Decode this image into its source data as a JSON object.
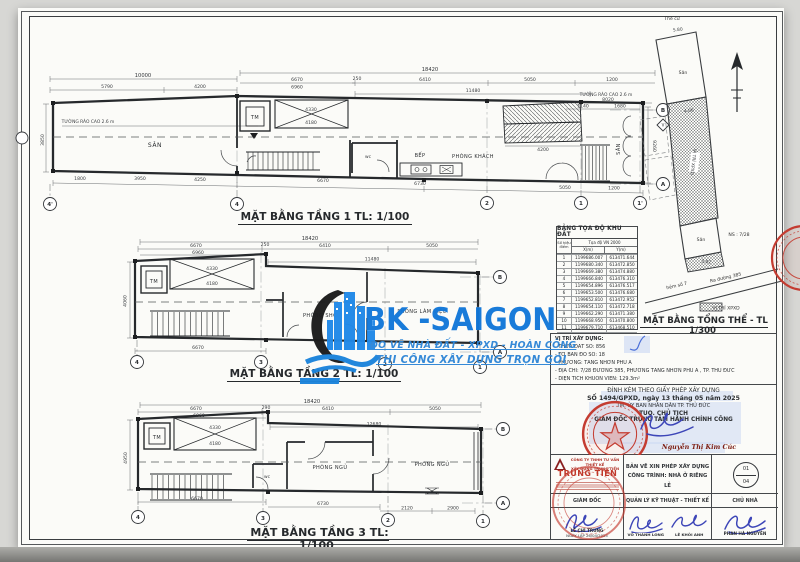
{
  "sheet": {
    "bg": "#fbfbf8",
    "line": "#3a3d40",
    "accent_red": "#c23b31",
    "signature_blue": "#3d46b8",
    "watermark_blue": "#1277d8",
    "highlight_blue": "#ccd9f2"
  },
  "watermark": {
    "brand": "BK -SAIGON",
    "tagline1": "ĐO VẼ NHÀ ĐẤT - XPXD - HOÀN CÔNG",
    "tagline2": "THI CÔNG XÂY DỰNG TRỌN GÓI"
  },
  "floor1": {
    "title": "MẶT BẰNG TẦNG 1 TL: 1/100",
    "rooms": {
      "san_left": "SÂN",
      "tm": "TM",
      "bep": "BẾP",
      "khach": "PHÒNG KHÁCH",
      "san_right": "SÂN",
      "wc": "wc"
    },
    "fence_note": "TƯỜNG RÀO CAO 2.6 m",
    "dims_top": [
      "10000",
      "5790",
      "4200",
      "18420",
      "6670",
      "6960",
      "250",
      "6410",
      "5050",
      "1200",
      "11480",
      "8020",
      "1140",
      "1680"
    ],
    "dims_bottom": [
      "1800",
      "3950",
      "4250",
      "6670",
      "6730",
      "5050",
      "1200"
    ],
    "dims_side": [
      "3850",
      "9260"
    ],
    "dims_inner": [
      "4330",
      "4180",
      "4200"
    ],
    "grids": [
      "4'",
      "4",
      "2",
      "1",
      "1'",
      "B",
      "A",
      "V"
    ]
  },
  "floor2": {
    "title": "MẶT BẰNG TẦNG 2 TL: 1/100",
    "rooms": {
      "tm": "TM",
      "shc": "PHÒNG SHC",
      "lam_viec": "PHÒNG LÀM VIỆC"
    },
    "dims_top": [
      "18420",
      "6670",
      "6960",
      "250",
      "6410",
      "5050",
      "11480"
    ],
    "dims_bottom": [
      "6670"
    ],
    "dims_side": [
      "4060"
    ],
    "dims_inner": [
      "4330",
      "4180"
    ],
    "grids": [
      "4",
      "3",
      "2",
      "1",
      "B",
      "A"
    ]
  },
  "floor3": {
    "title": "MẶT BẰNG TẦNG 3 TL: 1/100",
    "rooms": {
      "tm": "TM",
      "ngu1": "PHÒNG NGỦ",
      "ngu2": "PHÒNG NGỦ",
      "wc": "wc"
    },
    "dims_top": [
      "18420",
      "6670",
      "6960",
      "290",
      "6410",
      "5050",
      "12680"
    ],
    "dims_bottom": [
      "6670",
      "6730",
      "2120",
      "2900"
    ],
    "dims_side": [
      "4950"
    ],
    "dims_inner": [
      "4330",
      "4180"
    ],
    "grids": [
      "4",
      "3",
      "2",
      "1",
      "B",
      "A"
    ]
  },
  "site": {
    "title": "MẶT BẰNG TỔNG THỂ - TL 1/300",
    "labels": {
      "the_cu": "Thế cư",
      "san_top": "Sân",
      "san_low": "Sân",
      "ns": "NS : 7/28",
      "hem": "hẻm số 7",
      "duong": "Ra đường 385",
      "strip": "VỊ TRÍ XPXD",
      "d1": "5.80",
      "d2": "4.06",
      "d3": "3.82"
    },
    "legend_label": "VỊ TRÍ XPXD"
  },
  "table": {
    "title": "BẢNG TỌA ĐỘ KHU ĐẤT",
    "col_point": "Số hiệu điểm",
    "col_group": "Tọa độ VN 2000",
    "col_x": "X(m)",
    "col_y": "Y(m)",
    "rows": [
      [
        "1",
        "1199686.007",
        "613471.644"
      ],
      [
        "2",
        "1199680.340",
        "613472.850"
      ],
      [
        "3",
        "1199669.380",
        "613474.880"
      ],
      [
        "4",
        "1199666.840",
        "613476.310"
      ],
      [
        "5",
        "1199654.896",
        "613476.517"
      ],
      [
        "6",
        "1199653.500",
        "613476.680"
      ],
      [
        "7",
        "1199652.810",
        "613472.952"
      ],
      [
        "8",
        "1199654.110",
        "613472.718"
      ],
      [
        "9",
        "1199662.290",
        "613471.380"
      ],
      [
        "10",
        "1199668.950",
        "613470.800"
      ],
      [
        "11",
        "1199679.710",
        "613468.510"
      ],
      [
        "12",
        "1199683.590",
        "613468.200"
      ],
      [
        "13",
        "1199685.360",
        "613467.850"
      ]
    ]
  },
  "location": {
    "heading": "VỊ TRÍ XÂY DỰNG:",
    "lines": [
      "- THỬA ĐẤT SỐ:  856",
      "- TỜ BẢN ĐỒ SỐ:  18",
      "- PHƯỜNG:  TĂNG NHƠN PHÚ A",
      "- ĐỊA CHỈ:  7/28 ĐƯỜNG 385, PHƯỜNG TĂNG NHƠN PHÚ A , TP. THỦ ĐỨC",
      "- DIỆN TÍCH KHUÔN VIÊN:  129.3m²"
    ]
  },
  "permit": {
    "line1": "ĐÍNH KÈM THEO GIẤY PHÉP XÂY DỰNG",
    "line2": "SỐ 1494/GPXD, ngày 13 tháng 05 năm 2025",
    "line3": "TM. ỦY BAN NHÂN DÂN TP. THỦ ĐỨC",
    "line4": "TUQ. CHỦ TỊCH",
    "line5": "GIÁM ĐỐC TRUNG TÂM HÀNH CHÍNH CÔNG",
    "signer": "Nguyễn Thị Kim Cúc"
  },
  "titleblock": {
    "company_line1": "CÔNG TY TNHH TƯ VẤN THIẾT KẾ",
    "company_line2": "XÂY DỰNG TRUNG TIẾN",
    "company_name": "TRUNG TIẾN",
    "role1": "GIÁM ĐỐC",
    "name1": "LÊ CHÍ TRUNG",
    "date_line": "NGÀY LẬP 26/04/2025",
    "doc_line1": "BẢN VẼ XIN PHÉP XÂY DỰNG",
    "doc_line2": "CÔNG TRÌNH: NHÀ Ở RIÊNG LẺ",
    "role2": "QUẢN LÝ KỸ THUẬT - THIẾT KẾ",
    "name2a": "VÕ THÀNH LONG",
    "name2b": "LÊ KHÔI ANH",
    "role3": "CHỦ NHÀ",
    "name3": "PHAN HÀ NGUYÊN",
    "sheet_no": "01",
    "sheet_total": "04"
  }
}
